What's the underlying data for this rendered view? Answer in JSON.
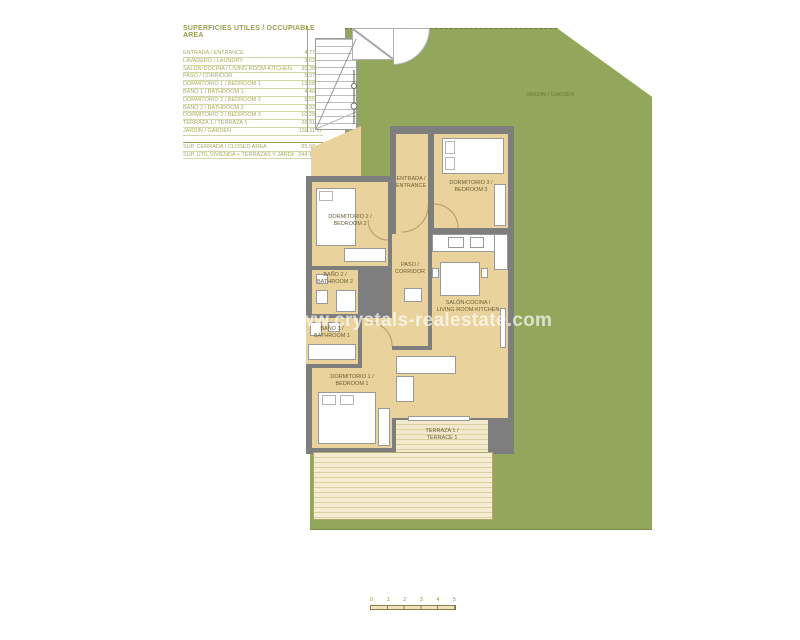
{
  "legend": {
    "title": "SUPERFICIES UTILES / OCCUPIABLE AREA",
    "rows": [
      {
        "label": "ENTRADA / ENTRANCE",
        "value": "4.77 m²"
      },
      {
        "label": "LAVADERO / LAUNDRY",
        "value": "3.62 m²"
      },
      {
        "label": "SALÓN-COCINA / LIVING ROOM-KITCHEN",
        "value": "30.38 m²"
      },
      {
        "label": "PASO / CORRIDOR",
        "value": "5.07 m²"
      },
      {
        "label": "DORMITORIO 1 / BEDROOM 1",
        "value": "13.68 m²"
      },
      {
        "label": "BAÑO 1 / BATHROOM 1",
        "value": "4.40 m²"
      },
      {
        "label": "DORMITORIO 2 / BEDROOM 2",
        "value": "9.55 m²"
      },
      {
        "label": "BAÑO 2 / BATHROOM 2",
        "value": "3.92 m²"
      },
      {
        "label": "DORMITORIO 3 / BEDROOM 3",
        "value": "10.28 m²"
      },
      {
        "label": "TERRAZA 1 / TERRAZA 1",
        "value": "26.91 m²"
      },
      {
        "label": "JARDIN / GARDEN",
        "value": "132.11 m²"
      }
    ],
    "summary_rows": [
      {
        "label": "SUP. CERRADA / CLOSED AREA",
        "value": "85.08 m²"
      },
      {
        "label": "SUP. ÚTIL VIVIENDA + TERRAZAS Y JARDÍN",
        "value": "244.19 m²"
      }
    ]
  },
  "plan": {
    "rooms": {
      "entrada": {
        "line1": "ENTRADA /",
        "line2": "ENTRANCE"
      },
      "bedroom3": {
        "line1": "DORMITORIO 3 /",
        "line2": "BEDROOM 3"
      },
      "bedroom2": {
        "line1": "DORMITORIO 2 /",
        "line2": "BEDROOM 2"
      },
      "paso": {
        "line1": "PASO /",
        "line2": "CORRIDOR"
      },
      "bano2": {
        "line1": "BAÑO 2 /",
        "line2": "BATHROOM 2"
      },
      "bano1": {
        "line1": "BAÑO 1 /",
        "line2": "BATHROOM 1"
      },
      "salon": {
        "line1": "SALÓN-COCINA /",
        "line2": "LIVING ROOM-KITCHEN"
      },
      "bedroom1": {
        "line1": "DORMITORIO 1 /",
        "line2": "BEDROOM 1"
      },
      "terraza": {
        "line1": "TERRAZA 1 /",
        "line2": "TERRACE 1"
      }
    },
    "garden_label": "JARDIN / GARDEN",
    "watermark": "www.crystals-realestate.com"
  },
  "scale": {
    "ticks": [
      {
        "n": "0"
      },
      {
        "n": "1"
      },
      {
        "n": "2"
      },
      {
        "n": "3"
      },
      {
        "n": "4"
      },
      {
        "n": "5"
      }
    ]
  },
  "colors": {
    "garden": "#93a75c",
    "floor": "#e9d29c",
    "wall": "#7e7e7e",
    "terrace_stripe": "#f3e9cd",
    "legend_text": "#a8ad62",
    "legend_title": "#9aa04e",
    "watermark_white": "#ffffff"
  }
}
